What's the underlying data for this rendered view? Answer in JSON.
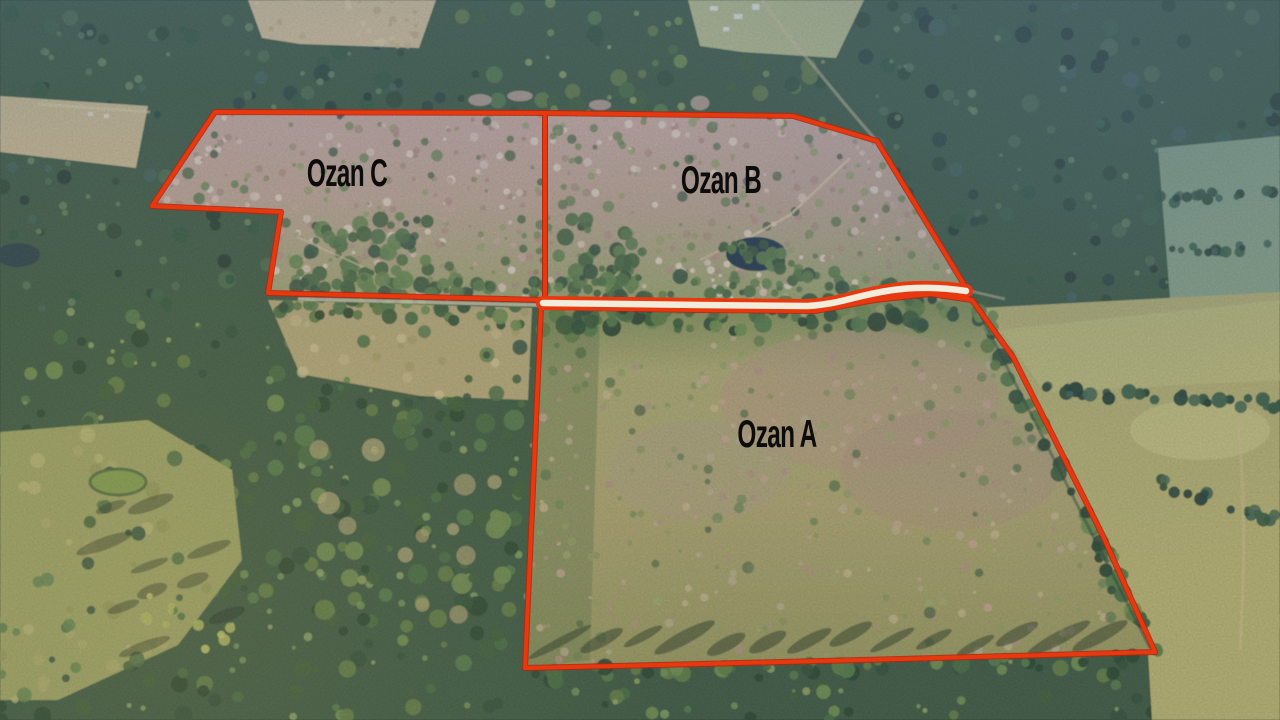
{
  "image_kind": "aerial-drone-photo-with-parcel-overlay",
  "colors": {
    "boundary": "#e8380f",
    "boundary_shadow": "#b3260c",
    "road_fill": "#f2ecdb",
    "label": "#0c0c0c"
  },
  "parcels": [
    {
      "id": "ozan-c",
      "label": "Ozan C",
      "label_cx": 347,
      "label_cy": 186,
      "outline": "215,112 545,113 545,300 268,293 281,212 152,206"
    },
    {
      "id": "ozan-b",
      "label": "Ozan B",
      "label_cx": 721,
      "label_cy": 193,
      "outline": "545,113 793,116 877,141 968,291 930,286 870,293 812,304 700,303 545,301"
    },
    {
      "id": "ozan-a",
      "label": "Ozan A",
      "label_cx": 777,
      "label_cy": 447,
      "outline": "541,307 700,310 815,311 875,300 930,294 972,300 1013,357 1052,434 1103,536 1155,652 900,659 700,664 525,668"
    }
  ],
  "road_band": {
    "path": "M 543,303 L 700,305 L 808,306 C 842,304 856,295 893,290 C 913,287 940,287 966,291"
  }
}
